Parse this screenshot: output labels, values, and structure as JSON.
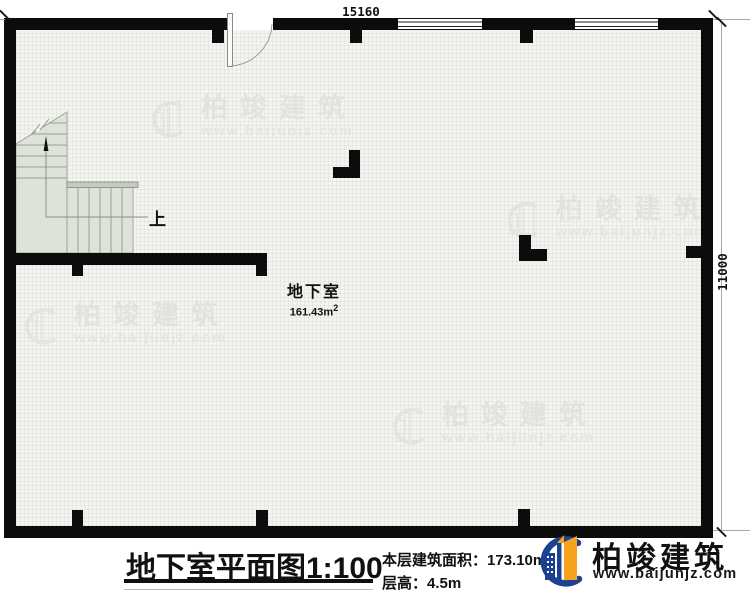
{
  "plan": {
    "dim_top": "15160",
    "dim_right": "11000",
    "room_name": "地下室",
    "room_area_value": "161.43m",
    "room_area_sup": "2",
    "stairs_up_label": "上"
  },
  "footer": {
    "title": "地下室平面图",
    "scale": "1:100",
    "area_label": "本层建筑面积：",
    "area_value": "173.10m",
    "area_sup": "2",
    "height_label": "层高：",
    "height_value": "4.5m"
  },
  "brand": {
    "name": "柏竣建筑",
    "url": "www.baijunjz.com",
    "colors": {
      "blue": "#1b4190",
      "orange": "#f6a21c",
      "wall": "#0c0c0c",
      "stair_fill": "#dde3d8"
    }
  },
  "watermark": {
    "name": "柏竣建筑",
    "url": "www.baijunjz.com"
  }
}
